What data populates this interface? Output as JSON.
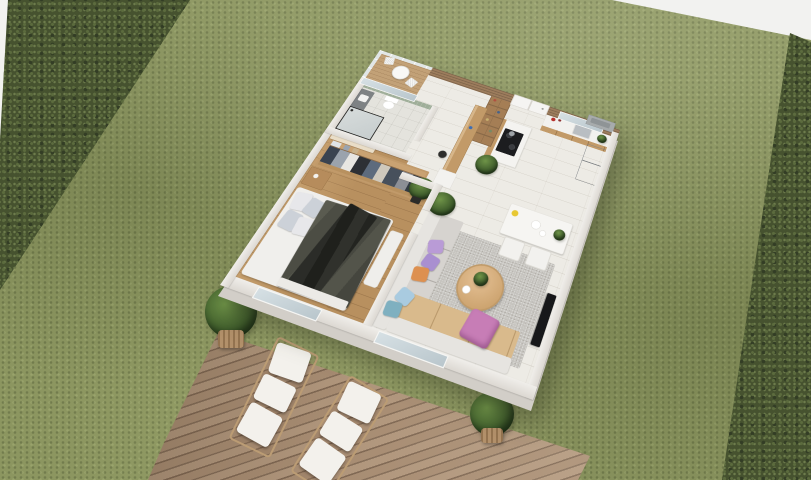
{
  "scene": {
    "type": "isometric-3d-floor-plan-render",
    "label": "Aerial 3D render of a one-bedroom apartment floor plan set on a lawn between two hedges, with a wooden sun deck",
    "environment": {
      "lawn": "grass field",
      "hedge_left": "trimmed hedge, upper-left diagonal",
      "hedge_right": "trimmed hedge, right edge",
      "deck": "diagonal plank deck, bottom, with two sun loungers and two potted plants",
      "sky": "white background visible in top-left and top-right corners"
    }
  },
  "palette": {
    "bg": "#f2f2f0",
    "grass": "#8c9660",
    "hedge": "#46522f",
    "deck": "#a78c72",
    "wall": "#dcd8d2",
    "floor-main": "#edebe5",
    "floor-wood": "#b8905f",
    "balcony-wood": "#c2a177",
    "top-wall-wood": "#9c7c5c",
    "glass": "#b9c6cc",
    "counter": "#f2f1ee",
    "cabinet-wood": "#c29a68",
    "cooktop": "#1c1d1f",
    "fridge": "#8f9397",
    "tile-green": "#9fae99",
    "rug": "#c7c5c0",
    "sofa": "#d6d3cf",
    "sofa-tan": "#d9ba8c",
    "ottoman": "#c77db6",
    "pillow-lilac": "#b99bd6",
    "pillow-orange": "#dd9050",
    "pillow-blue": "#a9cbe0",
    "pillow-teal": "#7fb0c0",
    "blanket": "#52534a",
    "mattress": "#f0efec",
    "wardrobe-wood": "#c19a6a",
    "plant": "#2f4a22",
    "pot-basket": "#b2906a",
    "tv": "#17181a",
    "table-white": "#f6f5f2",
    "table-wood": "#cda470",
    "flower-yellow": "#e8c832",
    "kettle-red": "#b62f2a"
  },
  "rooms": [
    {
      "name": "balcony-terrace",
      "label": "Top corner terrace",
      "items": [
        "wood plank floor",
        "glass railing",
        "white bistro table",
        "two bistro chairs"
      ]
    },
    {
      "name": "bathroom",
      "label": "Bathroom",
      "items": [
        "sage green tile wall",
        "glass wall to terrace",
        "dark vanity with sink",
        "toilet",
        "black-framed shower"
      ]
    },
    {
      "name": "hallway",
      "label": "Entry hall",
      "items": [
        "white entry door",
        "wooden bookshelf",
        "wooden desk counter",
        "black stool",
        "white cabinet"
      ]
    },
    {
      "name": "kitchen",
      "label": "Kitchen",
      "items": [
        "counter with sink and window",
        "wood base cabinets",
        "island with black cooktop",
        "stainless fridge",
        "red kettle",
        "outdoor AC unit",
        "potted plant"
      ]
    },
    {
      "name": "dining",
      "label": "Dining area",
      "items": [
        "white table",
        "two white chairs",
        "yellow flowers",
        "white plates",
        "table plant"
      ]
    },
    {
      "name": "living-room",
      "label": "Living room",
      "items": [
        "L-shaped sofa with tan chaise",
        "lilac, orange, blue and teal pillows",
        "gray rug",
        "round wooden coffee table with plant",
        "pink ottoman",
        "wall TV",
        "tall plant",
        "glass slider to deck"
      ]
    },
    {
      "name": "bedroom",
      "label": "Bedroom",
      "items": [
        "wood floor",
        "open wardrobe with hanging clothes",
        "beige canopy",
        "nightstand",
        "double bed with white pillows",
        "dark olive blanket and black throw",
        "white bench",
        "potted plant",
        "french glass door"
      ]
    }
  ],
  "outdoor_items": [
    {
      "name": "sun-lounger",
      "count": 2,
      "label": "White cushioned wooden sun loungers on deck"
    },
    {
      "name": "deck-plant",
      "count": 2,
      "label": "Potted grasses in woven baskets"
    }
  ]
}
